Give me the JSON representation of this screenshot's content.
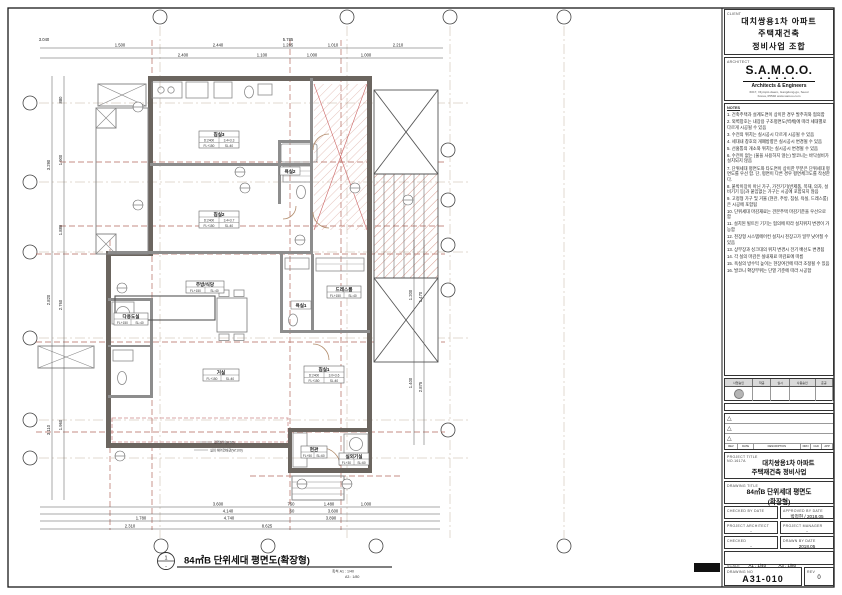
{
  "sheet": {
    "client": {
      "label": "CLIENT",
      "line1": "대치쌍용1차 아파트",
      "line2": "주택재건축",
      "line3": "정비사업 조합"
    },
    "architect": {
      "label": "ARCHITECT",
      "logo": "S.A.M.O.O.",
      "dots": "▲▲▲▲▲",
      "tagline": "Architects & Engineers",
      "address1": "6017, Olympic-daero, Gangdong-gu, Seoul",
      "address2": "Korea, 05540   www.samoo.com"
    },
    "notes": {
      "label": "NOTES",
      "items": [
        "1. 건축주택과 설계도면이 상이한 경우 발주처와 협의함",
        "2. 외벽창호는 내장용 구조평면도(벽체)에 따라 세대별로 다르게 시공될 수 있음",
        "3. 수전의 위치는 실시공시 다르게 시공될 수 있음",
        "4. 세대내 창호의 개폐방향은 실시공시 변경될 수 있음",
        "5. 선홈통의 개소와 위치는 실시공시 변경될 수 있음",
        "6. 수전이 없는 (물을 사용하지 않는) 발코니는 바닥설비가 설치되지 않음",
        "7. 단위세대 평면도와 타도면이 상이한 부분은 단위세대 평면도를 우선 함. 단, 평면이 다른 경우 평면체크도를 작성한다.",
        "8. 붙박이장이 아닌 가구, 가전기기(반제품, 목재, 의자, 설비기기 등)과 붙임없는 가구는 시공에 포함되지 않음",
        "9. 고정형 가구 및 거울 (현관, 주방, 침실, 욕실, 드레스룸)은 시공에 포함됨",
        "10. 단위세대 마감재료는 견본주택 마감기준을 우선으로 함",
        "11. 설치된 빌트인 기기는 협의에 따라 설치위치 변경이 가능함",
        "12. 천장형 시스템에어컨 설치시 천장고가 일부 낮아질 수 있음",
        "13. 상부장과 싱크대의 위치 변경시 전기 배선도 변경됨",
        "14. 각 실의 마감은 실내재료 마감표에 따름",
        "15. 욕실의 방수턱 높이는 현장여건에 따라 조정될 수 있음",
        "16. 발코니 확장부위는 단열 기준에 따라 시공함"
      ]
    },
    "stamp": {
      "h1": "사업승인",
      "h2": "착공",
      "h3": "실시",
      "h4": "사용승인",
      "h5": "준공"
    },
    "revision": {
      "h1": "REV",
      "h2": "DATE",
      "h3": "DESCRIPTION",
      "h4": "DRN",
      "h5": "CHK",
      "h6": "APP",
      "tri": "△"
    },
    "project": {
      "label": "PROJECT TITLE",
      "no": "NO.1617A",
      "line1": "대치쌍용1차 아파트",
      "line2": "주택재건축 정비사업"
    },
    "drawing": {
      "label": "DRAWING TITLE",
      "line1": "84㎡B 단위세대 평면도",
      "line2": "(확장형)"
    },
    "signoff": {
      "checked_by_label": "CHECKED BY DATE",
      "checked_by": "",
      "approved_by_label": "APPROVED BY DATE",
      "approved_by": "박정현 / 2018.05",
      "pa_label": "PROJECT ARCHITECT",
      "pa": "-",
      "pm_label": "PROJECT MANAGER",
      "pm": "-",
      "checked_label": "CHECKED",
      "checked": "-",
      "drawn_label": "DRAWN BY DATE",
      "drawn": "2018.05",
      "scale_label": "SCALE",
      "scale_a1": "A1 : 1/40",
      "scale_a3": "A3 : 1/80",
      "dwgno_label": "DRAWING NO",
      "dwgno": "A31-010",
      "rev_label": "REV",
      "rev": "0"
    }
  },
  "plan": {
    "title": "84㎡B 단위세대 평면도(확장형)",
    "title_tag_top": "1",
    "title_tag_bottom": "-",
    "scale1": "축척  A1 : 1/40",
    "scale2": "A3 : 1/80",
    "rooms": {
      "bedroom3": {
        "name": "침실3",
        "d": "D:2400",
        "size": "3.4×3.3",
        "fl": "FL+150",
        "sl": "SL:40"
      },
      "bedroom2": {
        "name": "침실2",
        "d": "D:2400",
        "size": "3.4×3.7",
        "fl": "FL+150",
        "sl": "SL:40"
      },
      "bedroom1": {
        "name": "침실1",
        "d": "D:2400",
        "size": "3.0×3.6",
        "fl": "FL+150",
        "sl": "SL:40"
      },
      "kitchen": {
        "name": "주방/식당",
        "fl": "FL+150",
        "sl": "SL:40"
      },
      "living": {
        "name": "거실",
        "fl": "FL+150",
        "sl": "SL:40"
      },
      "dress": {
        "name": "드레스룸",
        "fl": "FL+150",
        "sl": "SL:40"
      },
      "utility": {
        "name": "다용도실",
        "fl": "FL+150",
        "sl": "SL:40"
      },
      "entrance": {
        "name": "현관",
        "fl": "FL+50",
        "sl": "SL:60"
      },
      "acroom": {
        "name": "실외기실",
        "fl": "FL+30",
        "sl": "SL:60"
      },
      "bath1": {
        "name": "욕실1"
      },
      "bath2": {
        "name": "욕실2"
      }
    },
    "callouts": {
      "c1": "걸레받이(H:60)",
      "c2": "실외 에어컨배관(W:100)"
    },
    "dims": {
      "top_left": "3.040",
      "top_overall": "5.785",
      "top1": [
        "1.500",
        "2.440",
        "1.285",
        "1.010",
        "2.210"
      ],
      "top2": [
        "2.400",
        "1.100",
        "1.000",
        "1.000"
      ],
      "bottom1": [
        "3.600",
        "750",
        "1.480",
        "1.000"
      ],
      "bottom2": [
        "4.140",
        "60",
        "3.600"
      ],
      "bottom3": [
        "1.780",
        "4.740",
        "3.890"
      ],
      "bottom4": [
        "2.310",
        "8.625"
      ],
      "left1": [
        "3.290",
        "2.820",
        "3.110"
      ],
      "left2": [
        "880",
        "1.900",
        "1.880",
        "2.760",
        "1.960"
      ],
      "right1": [
        "1.200",
        "1.400"
      ],
      "right2": [
        "1.470",
        "2.875"
      ]
    }
  }
}
